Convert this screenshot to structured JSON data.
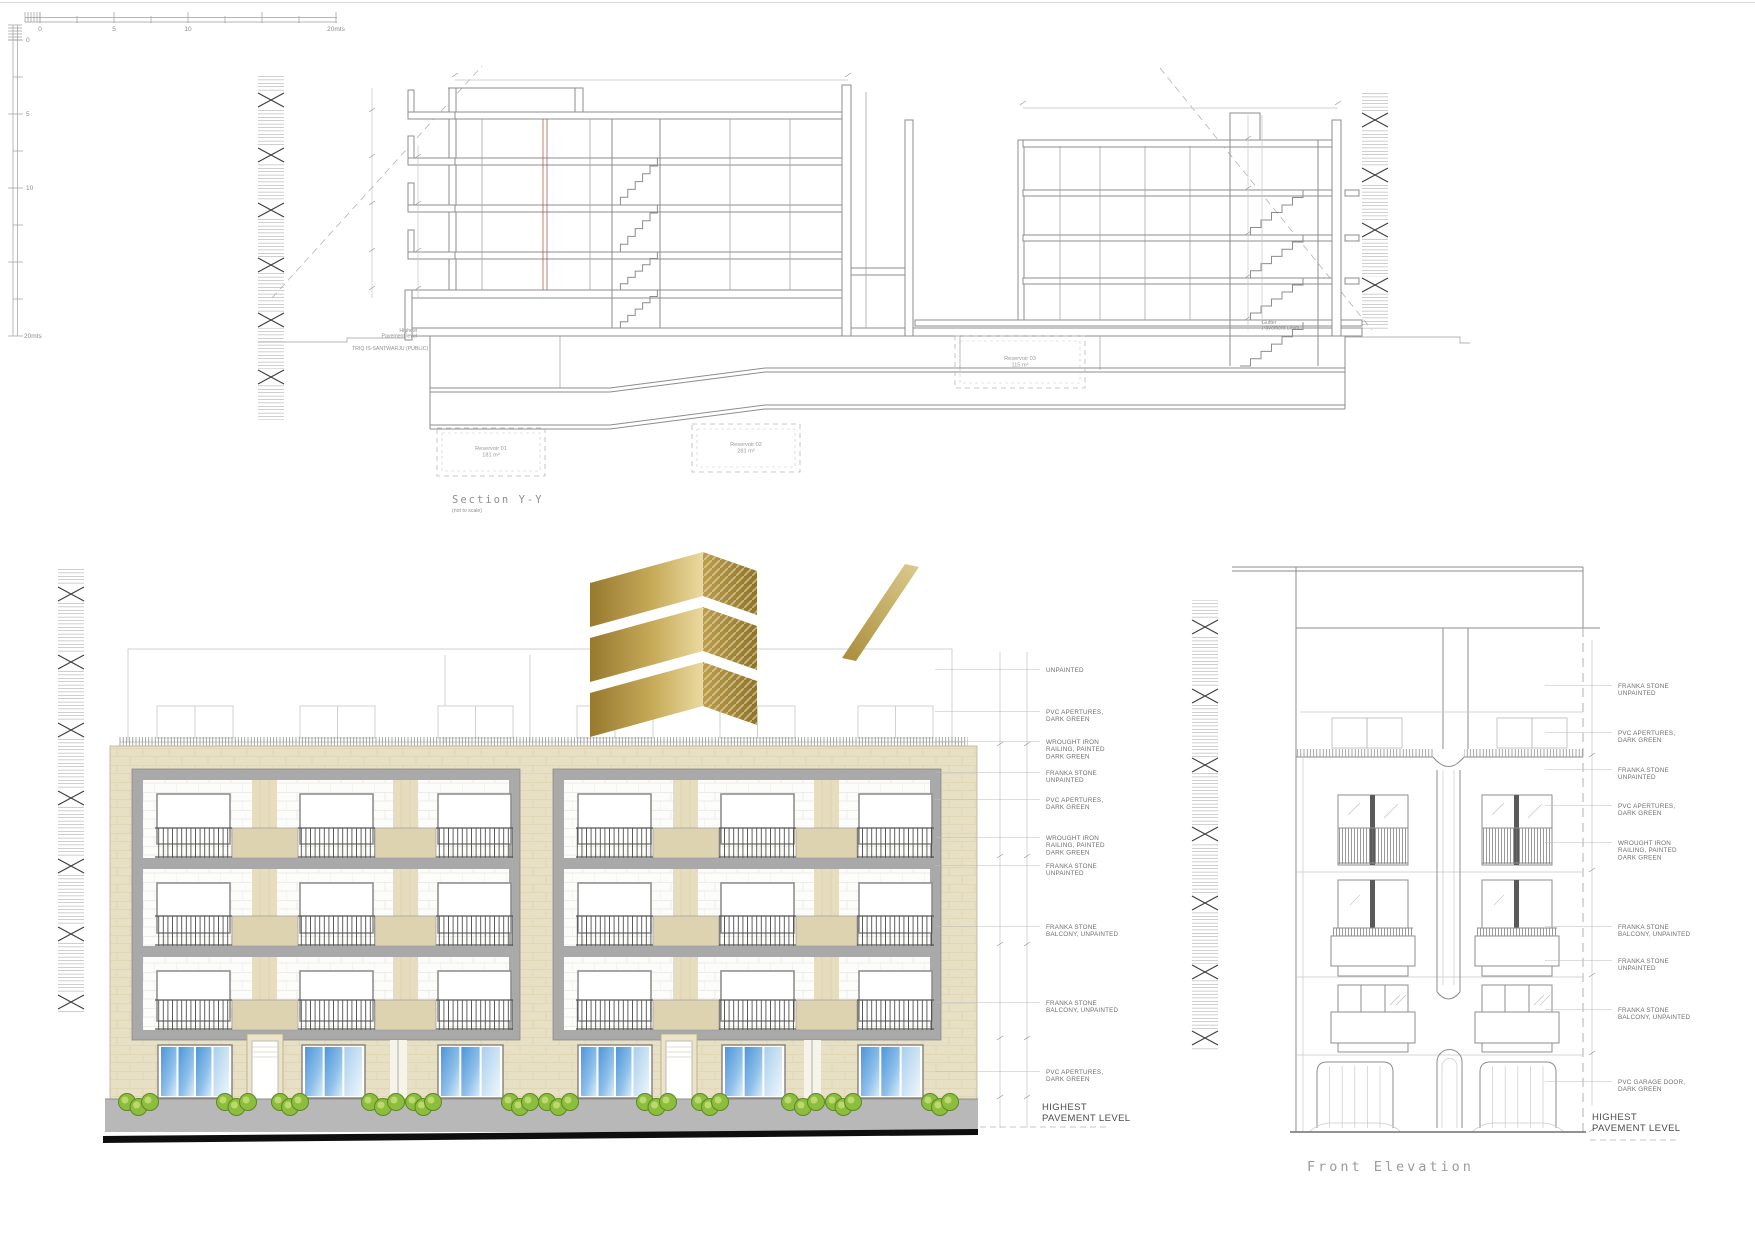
{
  "sheet": {
    "background": "#ffffff"
  },
  "colors": {
    "beige": "#e8e0c4",
    "beige_dark": "#ddd3b1",
    "pier": "#e6ddbf",
    "gray": "#a9a9a9",
    "line": "#8c8c8c",
    "label": "#6e6e6e",
    "dark_label": "#4b4b4b",
    "gold_dark": "#97792f",
    "gold_light": "#ead9a0",
    "blue_dark": "#4e96d8",
    "blue_light": "#d8ecfa",
    "bush": "#8cbd3c",
    "bush_dark": "#5d8726",
    "bush_light": "#bcd96d",
    "pavement": "#b8b8b8",
    "black_base": "#0e0e0e"
  },
  "scalebar": {
    "h_ticks": [
      "0",
      "5",
      "10",
      "20mts"
    ],
    "v_ticks": [
      "0",
      "5",
      "10",
      "20mts"
    ]
  },
  "section": {
    "title": "Section Y-Y",
    "subtitle": "(not to scale)",
    "left_street_note": [
      "Highest",
      "Pavement level"
    ],
    "left_street_name": "TRIQ IS-SANTWARJU (PUBLIC)",
    "right_street_note": [
      "Gutter",
      "Pavement Level"
    ],
    "reservoirs": [
      {
        "name": "Reservoir 01",
        "area": "181 m²"
      },
      {
        "name": "Reservoir 02",
        "area": "281 m²"
      },
      {
        "name": "Reservoir 03",
        "area": "115 m²"
      }
    ]
  },
  "left_elevation": {
    "labels": [
      {
        "y": 672,
        "lines": [
          "UNPAINTED"
        ]
      },
      {
        "y": 714,
        "lines": [
          "PVC APERTURES,",
          "DARK GREEN"
        ]
      },
      {
        "y": 744,
        "lines": [
          "WROUGHT IRON",
          "RAILING, PAINTED",
          "DARK GREEN"
        ]
      },
      {
        "y": 775,
        "lines": [
          "FRANKA STONE",
          "UNPAINTED"
        ]
      },
      {
        "y": 802,
        "lines": [
          "PVC APERTURES,",
          "DARK GREEN"
        ]
      },
      {
        "y": 840,
        "lines": [
          "WROUGHT IRON",
          "RAILING, PAINTED",
          "DARK GREEN"
        ]
      },
      {
        "y": 868,
        "lines": [
          "FRANKA STONE",
          "UNPAINTED"
        ]
      },
      {
        "y": 929,
        "lines": [
          "FRANKA STONE",
          "BALCONY, UNPAINTED"
        ]
      },
      {
        "y": 1005,
        "lines": [
          "FRANKA STONE",
          "BALCONY, UNPAINTED"
        ]
      },
      {
        "y": 1074,
        "lines": [
          "PVC APERTURES,",
          "DARK GREEN"
        ]
      }
    ],
    "pavement_note": [
      "HIGHEST",
      "PAVEMENT LEVEL"
    ]
  },
  "right_elevation": {
    "title": "Front Elevation",
    "labels": [
      {
        "y": 688,
        "lines": [
          "FRANKA STONE",
          "UNPAINTED"
        ]
      },
      {
        "y": 735,
        "lines": [
          "PVC APERTURES,",
          "DARK GREEN"
        ]
      },
      {
        "y": 772,
        "lines": [
          "FRANKA STONE",
          "UNPAINTED"
        ]
      },
      {
        "y": 808,
        "lines": [
          "PVC APERTURES,",
          "DARK GREEN"
        ]
      },
      {
        "y": 845,
        "lines": [
          "WROUGHT IRON",
          "RAILING, PAINTED",
          "DARK GREEN"
        ]
      },
      {
        "y": 929,
        "lines": [
          "FRANKA STONE",
          "BALCONY, UNPAINTED"
        ]
      },
      {
        "y": 963,
        "lines": [
          "FRANKA STONE",
          "UNPAINTED"
        ]
      },
      {
        "y": 1012,
        "lines": [
          "FRANKA STONE",
          "BALCONY, UNPAINTED"
        ]
      },
      {
        "y": 1084,
        "lines": [
          "PVC GARAGE DOOR,",
          "DARK GREEN"
        ]
      }
    ],
    "pavement_note": [
      "HIGHEST",
      "PAVEMENT LEVEL"
    ]
  }
}
